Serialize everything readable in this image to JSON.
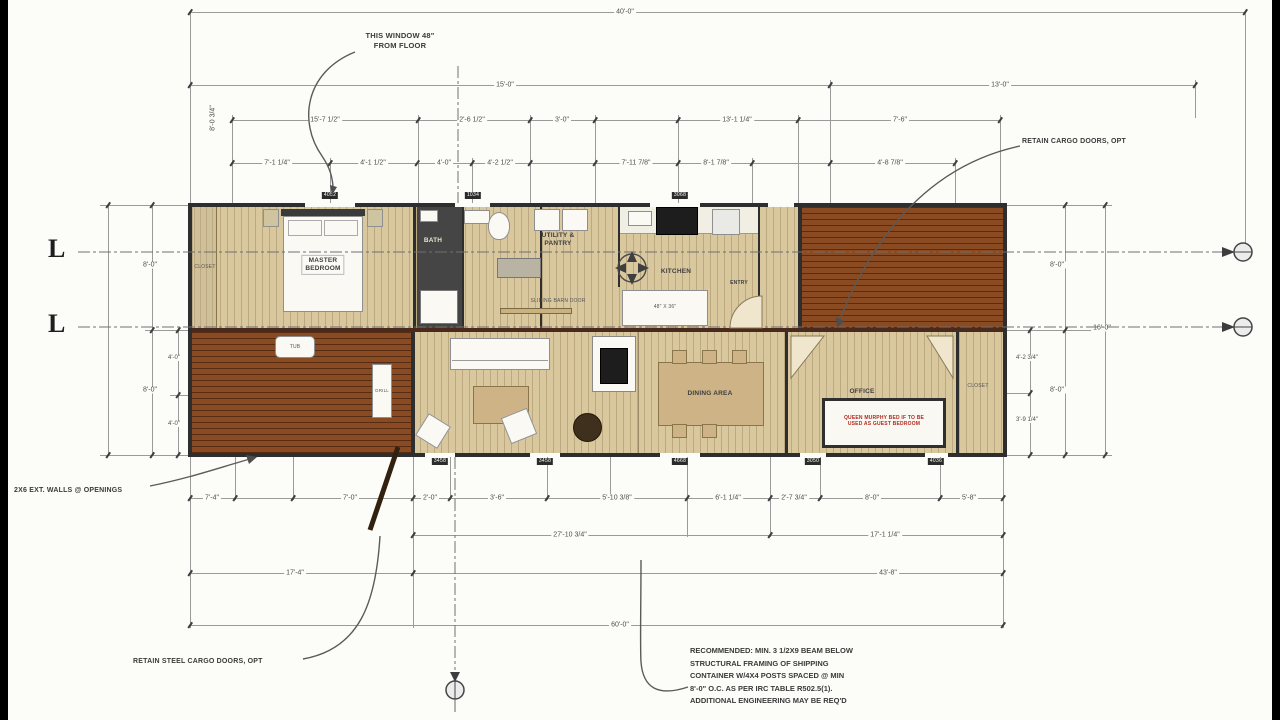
{
  "annotations": {
    "window_note": [
      "THIS WINDOW 48\"",
      "FROM FLOOR"
    ],
    "retain_cargo_doors": "RETAIN CARGO DOORS, OPT",
    "retain_steel_cargo_doors": "RETAIN STEEL CARGO DOORS, OPT",
    "ext_walls": "2X6 EXT. WALLS @ OPENINGS",
    "structural_note": [
      "RECOMMENDED: MIN. 3 1/2X9 BEAM BELOW",
      "STRUCTURAL FRAMING OF SHIPPING",
      "CONTAINER W/4X4 POSTS SPACED @ MIN",
      "8'-0\" O.C. AS PER IRC TABLE R502.5(1).",
      "ADDITIONAL ENGINEERING MAY BE REQ'D"
    ]
  },
  "section_markers": {
    "left_top": "L",
    "left_bottom": "L"
  },
  "rooms": {
    "master_bedroom": [
      "MASTER",
      "BEDROOM"
    ],
    "bath": "BATH",
    "utility_pantry": [
      "UTILITY &",
      "PANTRY"
    ],
    "kitchen": "KITCHEN",
    "entry": "ENTRY",
    "dining": "DINING AREA",
    "office": "OFFICE",
    "closet_left": "CLOSET",
    "closet_right": "CLOSET",
    "sliding_barn_door": "SLIDING BARN DOOR",
    "island_size": "48\" X 36\"",
    "tub": "TUB",
    "grill": "GRILL",
    "murphy_note": [
      "QUEEN MURPHY BED IF TO BE",
      "USED AS GUEST BEDROOM"
    ]
  },
  "window_door_tags": {
    "top": [
      "4052",
      "1034",
      "3068"
    ],
    "bottom": [
      "3458",
      "3458",
      "4668",
      "3050",
      "4036"
    ]
  },
  "dimensions": {
    "overall_top": "40'-0\"",
    "top_row2": [
      "15'-0\"",
      "13'-0\""
    ],
    "top_row3": [
      "15'-7 1/2\"",
      "2'-6 1/2\"",
      "3'-0\"",
      "13'-1 1/4\"",
      "7'-6\""
    ],
    "top_row4": [
      "7'-1 1/4\"",
      "4'-1 1/2\"",
      "4'-0\"",
      "4'-2 1/2\"",
      "7'-11 7/8\"",
      "8'-1 7/8\"",
      "4'-8 7/8\""
    ],
    "left": [
      "8'-0 3/4\"",
      "8'-0\"",
      "8'-0\"",
      "4'-0\"",
      "4'-0\""
    ],
    "right": [
      "8'-0\"",
      "8'-0\"",
      "4'-2 3/4\"",
      "3'-9 1/4\"",
      "16'-0\""
    ],
    "bottom_row1": [
      "7'-4\"",
      "7'-0\"",
      "2'-0\"",
      "3'-6\"",
      "5'-10 3/8\"",
      "6'-1 1/4\"",
      "2'-7 3/4\"",
      "8'-0\"",
      "5'-8\""
    ],
    "bottom_row2": [
      "27'-10 3/4\"",
      "17'-1 1/4\""
    ],
    "bottom_row3": [
      "17'-4\"",
      "43'-8\""
    ],
    "overall_bottom": "60'-0\""
  },
  "colors": {
    "deck": "#8a4a22",
    "wood_floor": "#d9c79e",
    "beam": "#4a2a1c",
    "wall": "#2e2e2e",
    "murphy_note_red": "#b02a20"
  }
}
